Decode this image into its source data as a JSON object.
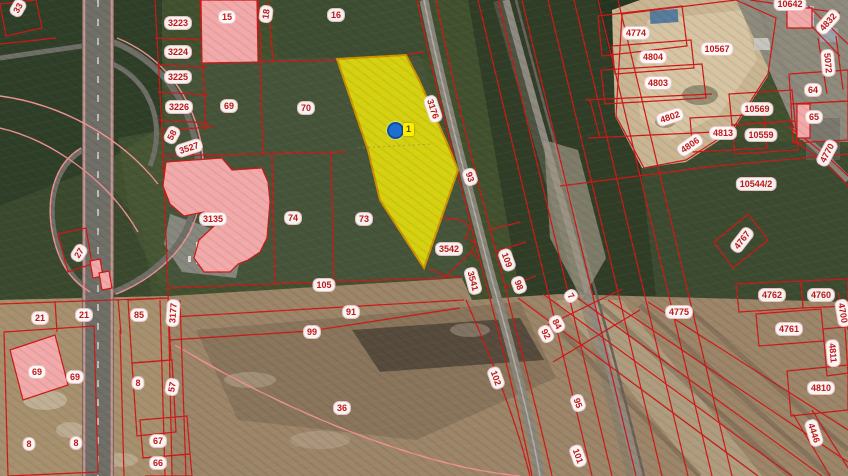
{
  "map": {
    "type": "cadastral-parcel-map-over-satellite",
    "colors": {
      "parcel_line": "#d01818",
      "label_text": "#c01818",
      "highlight_fill": "#e9e20a",
      "highlight_stroke": "#cf9300",
      "building_fill": "#f2a9a9",
      "marker_blue": "#1a6fd0",
      "marker_tag_bg": "#ffee00"
    },
    "selected_parcel": {
      "marker_tag": "1",
      "marker_x": 395,
      "marker_y": 130
    },
    "labels": [
      {
        "t": "33",
        "x": 18,
        "y": 8,
        "r": -60
      },
      {
        "t": "3223",
        "x": 178,
        "y": 23,
        "r": 0
      },
      {
        "t": "15",
        "x": 227,
        "y": 17,
        "r": 0
      },
      {
        "t": "18",
        "x": 266,
        "y": 14,
        "r": -83
      },
      {
        "t": "16",
        "x": 336,
        "y": 15,
        "r": 0
      },
      {
        "t": "3224",
        "x": 178,
        "y": 52,
        "r": 0
      },
      {
        "t": "3225",
        "x": 178,
        "y": 77,
        "r": 0
      },
      {
        "t": "3226",
        "x": 179,
        "y": 107,
        "r": 0
      },
      {
        "t": "69",
        "x": 229,
        "y": 106,
        "r": 0
      },
      {
        "t": "70",
        "x": 306,
        "y": 108,
        "r": 0
      },
      {
        "t": "58",
        "x": 172,
        "y": 135,
        "r": -62
      },
      {
        "t": "3527",
        "x": 189,
        "y": 148,
        "r": -18
      },
      {
        "t": "3176",
        "x": 433,
        "y": 109,
        "r": 72
      },
      {
        "t": "93",
        "x": 470,
        "y": 177,
        "r": 72
      },
      {
        "t": "3135",
        "x": 213,
        "y": 219,
        "r": 0
      },
      {
        "t": "74",
        "x": 293,
        "y": 218,
        "r": 0
      },
      {
        "t": "73",
        "x": 364,
        "y": 219,
        "r": 0
      },
      {
        "t": "27",
        "x": 79,
        "y": 253,
        "r": -58
      },
      {
        "t": "3542",
        "x": 449,
        "y": 249,
        "r": 0
      },
      {
        "t": "3541",
        "x": 473,
        "y": 281,
        "r": 75
      },
      {
        "t": "109",
        "x": 507,
        "y": 260,
        "r": 70
      },
      {
        "t": "98",
        "x": 519,
        "y": 285,
        "r": 70
      },
      {
        "t": "105",
        "x": 324,
        "y": 285,
        "r": 0
      },
      {
        "t": "7",
        "x": 571,
        "y": 296,
        "r": 55
      },
      {
        "t": "91",
        "x": 351,
        "y": 312,
        "r": 0
      },
      {
        "t": "99",
        "x": 312,
        "y": 332,
        "r": 0
      },
      {
        "t": "84",
        "x": 557,
        "y": 324,
        "r": 62
      },
      {
        "t": "92",
        "x": 546,
        "y": 334,
        "r": 62
      },
      {
        "t": "102",
        "x": 496,
        "y": 378,
        "r": 70
      },
      {
        "t": "95",
        "x": 578,
        "y": 403,
        "r": 70
      },
      {
        "t": "101",
        "x": 578,
        "y": 456,
        "r": 70
      },
      {
        "t": "36",
        "x": 342,
        "y": 408,
        "r": 0
      },
      {
        "t": "21",
        "x": 40,
        "y": 318,
        "r": 0
      },
      {
        "t": "21",
        "x": 84,
        "y": 315,
        "r": 0
      },
      {
        "t": "85",
        "x": 139,
        "y": 315,
        "r": 0
      },
      {
        "t": "3177",
        "x": 173,
        "y": 313,
        "r": -86
      },
      {
        "t": "69",
        "x": 37,
        "y": 372,
        "r": 0
      },
      {
        "t": "69",
        "x": 75,
        "y": 377,
        "r": 0
      },
      {
        "t": "8",
        "x": 138,
        "y": 383,
        "r": 0
      },
      {
        "t": "57",
        "x": 172,
        "y": 387,
        "r": -80
      },
      {
        "t": "8",
        "x": 29,
        "y": 444,
        "r": 0
      },
      {
        "t": "8",
        "x": 76,
        "y": 443,
        "r": 0
      },
      {
        "t": "67",
        "x": 158,
        "y": 441,
        "r": 0
      },
      {
        "t": "66",
        "x": 158,
        "y": 463,
        "r": 0
      },
      {
        "t": "4774",
        "x": 636,
        "y": 33,
        "r": 0
      },
      {
        "t": "10567",
        "x": 717,
        "y": 49,
        "r": 0
      },
      {
        "t": "10642",
        "x": 790,
        "y": 4,
        "r": 0
      },
      {
        "t": "4832",
        "x": 828,
        "y": 22,
        "r": -48
      },
      {
        "t": "5072",
        "x": 828,
        "y": 63,
        "r": 85
      },
      {
        "t": "4804",
        "x": 653,
        "y": 57,
        "r": 0
      },
      {
        "t": "4803",
        "x": 658,
        "y": 83,
        "r": 0
      },
      {
        "t": "64",
        "x": 813,
        "y": 90,
        "r": 0
      },
      {
        "t": "4802",
        "x": 670,
        "y": 117,
        "r": -18
      },
      {
        "t": "65",
        "x": 814,
        "y": 117,
        "r": 0
      },
      {
        "t": "10569",
        "x": 757,
        "y": 109,
        "r": 0
      },
      {
        "t": "4813",
        "x": 723,
        "y": 133,
        "r": 0
      },
      {
        "t": "10559",
        "x": 761,
        "y": 135,
        "r": 0
      },
      {
        "t": "4806",
        "x": 690,
        "y": 145,
        "r": -35
      },
      {
        "t": "4770",
        "x": 827,
        "y": 153,
        "r": -62
      },
      {
        "t": "10544/2",
        "x": 756,
        "y": 184,
        "r": 0
      },
      {
        "t": "4767",
        "x": 742,
        "y": 240,
        "r": -52
      },
      {
        "t": "4775",
        "x": 679,
        "y": 312,
        "r": 0
      },
      {
        "t": "4762",
        "x": 772,
        "y": 295,
        "r": 0
      },
      {
        "t": "4760",
        "x": 821,
        "y": 295,
        "r": 0
      },
      {
        "t": "4700",
        "x": 843,
        "y": 313,
        "r": 80
      },
      {
        "t": "4761",
        "x": 789,
        "y": 329,
        "r": 0
      },
      {
        "t": "4811",
        "x": 833,
        "y": 353,
        "r": 85
      },
      {
        "t": "4810",
        "x": 821,
        "y": 388,
        "r": 0
      },
      {
        "t": "4446",
        "x": 814,
        "y": 433,
        "r": 72
      }
    ]
  }
}
